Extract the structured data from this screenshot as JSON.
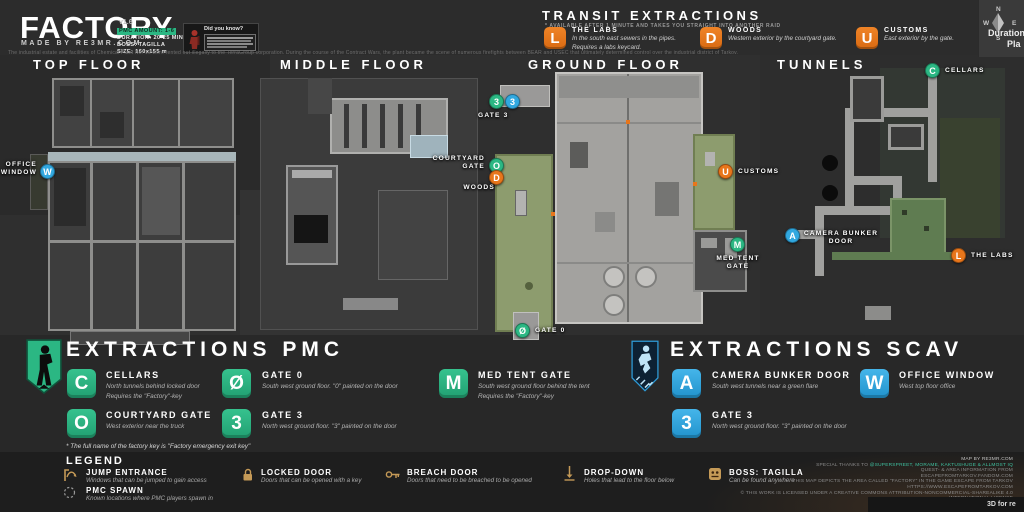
{
  "header": {
    "title": "FACTORY",
    "made_by": "MADE BY RE3MR.COM",
    "version": "v1.6",
    "stats": {
      "pmc_amount": "PMC AMOUNT: 1-6",
      "duration": "DURATION: 20-25 MIN.",
      "boss": "BOSS: TAGILLA",
      "size": "SIZE: 160x155 m"
    },
    "did_you_know_title": "Did you know?",
    "description": "The industrial estate and facilities of Chemical Plant No. 16 were rented out illegally to the TerraGroup corporation. During the course of the Contract Wars, the plant became the scene of numerous firefights between BEAR and USEC that ultimately determined control over the industrial district of Tarkov.",
    "compass": {
      "n": "N",
      "e": "E",
      "s": "S",
      "w": "W"
    },
    "edge": {
      "line1": "Duration",
      "line2": "Pla"
    }
  },
  "transit": {
    "title": "TRANSIT EXTRACTIONS",
    "note": "* AVAILABLE AFTER 1 MINUTE AND TAKES YOU STRAIGHT INTO ANOTHER RAID",
    "items": [
      {
        "letter": "L",
        "name": "THE LABS",
        "desc": "In the south east sewers in the pipes.\nRequires a labs keycard."
      },
      {
        "letter": "D",
        "name": "WOODS",
        "desc": "Western exterior by the courtyard gate."
      },
      {
        "letter": "U",
        "name": "CUSTOMS",
        "desc": "East exterior by the gate."
      }
    ]
  },
  "floor_labels": {
    "top": "TOP FLOOR",
    "middle": "MIDDLE FLOOR",
    "ground": "GROUND FLOOR",
    "tunnels": "TUNNELS"
  },
  "markers": {
    "office_window": {
      "letter": "W",
      "label": "OFFICE\nWINDOW"
    },
    "gate3_map": {
      "pmc_letter": "3",
      "scav_letter": "3",
      "label": "GATE 3"
    },
    "courtyard_gate": {
      "letter": "O",
      "label": "COURTYARD\nGATE"
    },
    "woods": {
      "letter": "D",
      "label": "WOODS"
    },
    "customs": {
      "letter": "U",
      "label": "CUSTOMS"
    },
    "med_tent": {
      "letter": "M",
      "label": "MED TENT\nGATE"
    },
    "gate0": {
      "letter": "Ø",
      "label": "GATE 0"
    },
    "camera_bunker": {
      "letter": "A",
      "label": "CAMERA BUNKER\nDOOR"
    },
    "cellars": {
      "letter": "C",
      "label": "CELLARS"
    },
    "labs": {
      "letter": "L",
      "label": "THE LABS"
    }
  },
  "pmc": {
    "title": "EXTRACTIONS PMC",
    "items": [
      {
        "letter": "C",
        "name": "CELLARS",
        "desc": "North tunnels behind locked door\nRequires the \"Factory\"-key"
      },
      {
        "letter": "O",
        "name": "COURTYARD GATE",
        "desc": "West exterior near the truck"
      },
      {
        "letter": "Ø",
        "name": "GATE 0",
        "desc": "South west ground floor. \"0\" painted on the door"
      },
      {
        "letter": "3",
        "name": "GATE 3",
        "desc": "North west ground floor. \"3\" painted on the door"
      },
      {
        "letter": "M",
        "name": "MED TENT GATE",
        "desc": "South west ground floor behind the tent\nRequires the \"Factory\"-key"
      }
    ],
    "footnote": "* The full name of the factory key is \"Factory emergency exit key\""
  },
  "scav": {
    "title": "EXTRACTIONS SCAV",
    "items": [
      {
        "letter": "A",
        "name": "CAMERA BUNKER DOOR",
        "desc": "South west tunnels near a green flare"
      },
      {
        "letter": "W",
        "name": "OFFICE WINDOW",
        "desc": "West top floor office"
      },
      {
        "letter": "3",
        "name": "GATE 3",
        "desc": "North west ground floor. \"3\" painted on the door"
      }
    ]
  },
  "legend": {
    "title": "LEGEND",
    "items": [
      {
        "name": "JUMP ENTRANCE",
        "desc": "Windows that can be jumped to gain access"
      },
      {
        "name": "PMC SPAWN",
        "desc": "Known locations where PMC players spawn in"
      },
      {
        "name": "LOCKED DOOR",
        "desc": "Doors that can be opened with a key"
      },
      {
        "name": "BREACH DOOR",
        "desc": "Doors that need to be breached to be opened"
      },
      {
        "name": "DROP-DOWN",
        "desc": "Holes that lead to the floor below"
      },
      {
        "name": "BOSS: TAGILLA",
        "desc": "Can be found anywhere"
      }
    ]
  },
  "credits": {
    "line1": "MAP BY RE3MR.COM",
    "line2_prefix": "SPECIAL THANKS TO ",
    "line2_names": "@SUPERSPREET, MORAME, KAKTUSHUGE & ALLMOST IQ",
    "line3": "QUEST- & AREA INFORMATION FROM",
    "line4": "ESCAPEFROMTARKOV.FANDOM.COM",
    "line5": "THIS MAP DEPICTS THE AREA CALLED \"FACTORY\" IN THE GAME ESCAPE FROM TARKOV",
    "line6": "HTTPS://WWW.ESCAPEFROMTARKOV.COM",
    "line7": "© THIS WORK IS LICENSED UNDER A CREATIVE COMMONS ATTRIBUTION-NONCOMMERCIAL-SHAREALIKE 4.0 INTERNATIONAL LICENSE",
    "corner": "3D for re"
  },
  "colors": {
    "pmc_green": "#2bb783",
    "scav_blue": "#31a8e0",
    "transit_orange": "#e8761b",
    "legend_tan": "#c59a57",
    "courtyard_green": "#8d9c6e"
  }
}
